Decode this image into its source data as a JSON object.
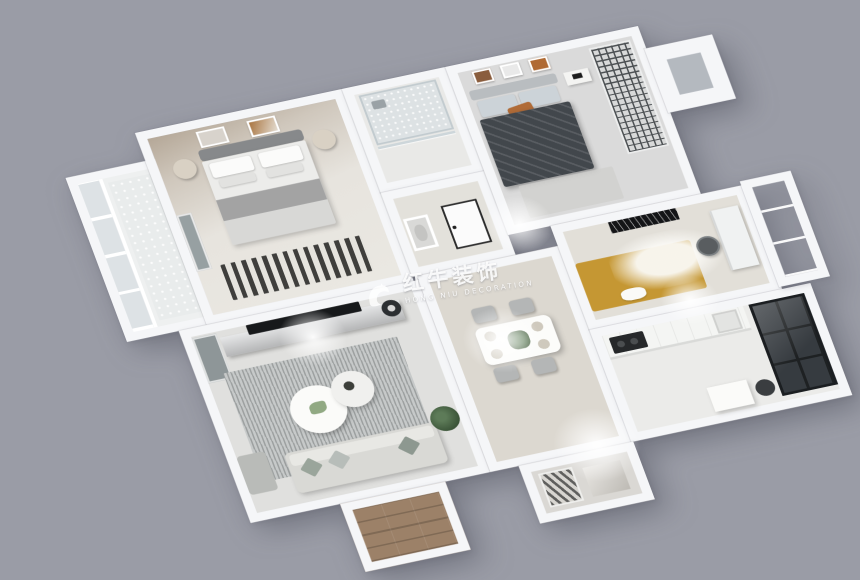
{
  "scene": {
    "description": "3D isometric rendered apartment floor plan on gray background",
    "background_color": "#9a9ca6",
    "wall_color": "#f5f6f8"
  },
  "watermark": {
    "title": "红牛装饰",
    "subtitle": "HONG NIU DECORATION",
    "color": "#ffffff",
    "logo": "hongniu-bull-logo"
  },
  "floorplan": {
    "rooms": [
      {
        "id": "balcony-left",
        "label": "left balcony",
        "floor_color": "#eef0f0",
        "furniture": [
          "window-frames",
          "tile-floor"
        ]
      },
      {
        "id": "master-bedroom",
        "label": "master bedroom",
        "floor_color": "#e7e4de",
        "wall_accent": "#b5a898",
        "furniture": [
          "double-bed",
          "headboard",
          "pillows",
          "gray-blankets",
          "nightstand-left",
          "nightstand-right",
          "wall-art-frames",
          "striped-rug",
          "wardrobe"
        ]
      },
      {
        "id": "bathroom",
        "label": "bathroom",
        "floor_color": "#e9e9e7",
        "furniture": [
          "glass-shower",
          "shower-head"
        ]
      },
      {
        "id": "hallway",
        "label": "hallway",
        "floor_color": "#e3e1db",
        "furniture": [
          "interior-door",
          "wall-niche"
        ]
      },
      {
        "id": "bedroom-2",
        "label": "second bedroom",
        "floor_color": "#dadada",
        "furniture": [
          "bed-dark-duvet",
          "orange-accent-pillow",
          "three-picture-frames",
          "nightstand",
          "lattice-screen-wardrobe"
        ]
      },
      {
        "id": "window-bay",
        "label": "window bay",
        "floor_color": "#b4b9bf",
        "furniture": []
      },
      {
        "id": "living-room",
        "label": "living room",
        "floor_color": "#e0e0de",
        "furniture": [
          "tv",
          "tv-console",
          "side-cabinet",
          "stool",
          "textured-area-rug",
          "round-coffee-table-large",
          "round-coffee-table-small",
          "sofa",
          "throw-pillows",
          "chaise",
          "floor-plant"
        ]
      },
      {
        "id": "dining-area",
        "label": "dining area",
        "floor_color": "#dcd8d0",
        "furniture": [
          "dining-table",
          "four-chairs",
          "place-settings",
          "centerpiece-plant"
        ]
      },
      {
        "id": "study-bedroom",
        "label": "study / kids bedroom",
        "floor_color": "#e2dfd8",
        "furniture": [
          "yellow-daybed",
          "white-shag-rug",
          "desk",
          "desk-chair",
          "dark-wall-art"
        ]
      },
      {
        "id": "kitchen",
        "label": "kitchen",
        "floor_color": "#ebebe9",
        "furniture": [
          "counter",
          "cooktop",
          "sink",
          "dark-glass-cabinet",
          "island",
          "appliance"
        ]
      },
      {
        "id": "balcony-right",
        "label": "right balcony",
        "floor_color": "#ccd1d5",
        "furniture": []
      },
      {
        "id": "entry",
        "label": "entry porch",
        "floor_color": "#9c8168",
        "furniture": [
          "wood-plank-floor"
        ]
      },
      {
        "id": "foyer",
        "label": "foyer",
        "floor_color": "#dad8d4",
        "furniture": [
          "patterned-accent-panel",
          "downlights"
        ]
      }
    ]
  }
}
